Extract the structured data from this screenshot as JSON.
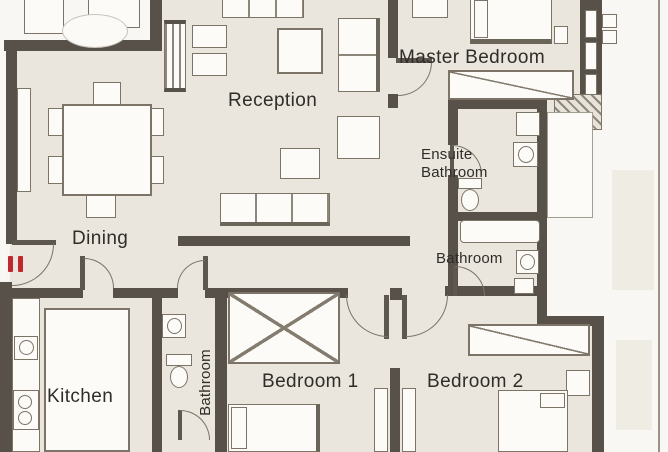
{
  "title": "Apartment floor plan",
  "rooms": {
    "reception": {
      "label": "Reception"
    },
    "master_bedroom": {
      "label": "Master Bedroom"
    },
    "ensuite_bathroom": {
      "line1": "Ensuite",
      "line2": "Bathroom"
    },
    "bathroom_main": {
      "label": "Bathroom"
    },
    "dining": {
      "label": "Dining"
    },
    "kitchen": {
      "label": "Kitchen"
    },
    "bathroom_small": {
      "label": "Bathroom"
    },
    "bedroom_1": {
      "label": "Bedroom 1"
    },
    "bedroom_2": {
      "label": "Bedroom 2"
    }
  },
  "entrance": {
    "marker_icon": "entrance-marker",
    "marker_color": "#c1282e"
  },
  "palette": {
    "wall": "#57514a",
    "floor": "#eae6dd",
    "outside": "#f8f7f3",
    "furniture_line": "#7b7467",
    "text": "#2f2d29",
    "accent_red": "#c1282e",
    "plot_boundary": "#98928a"
  }
}
